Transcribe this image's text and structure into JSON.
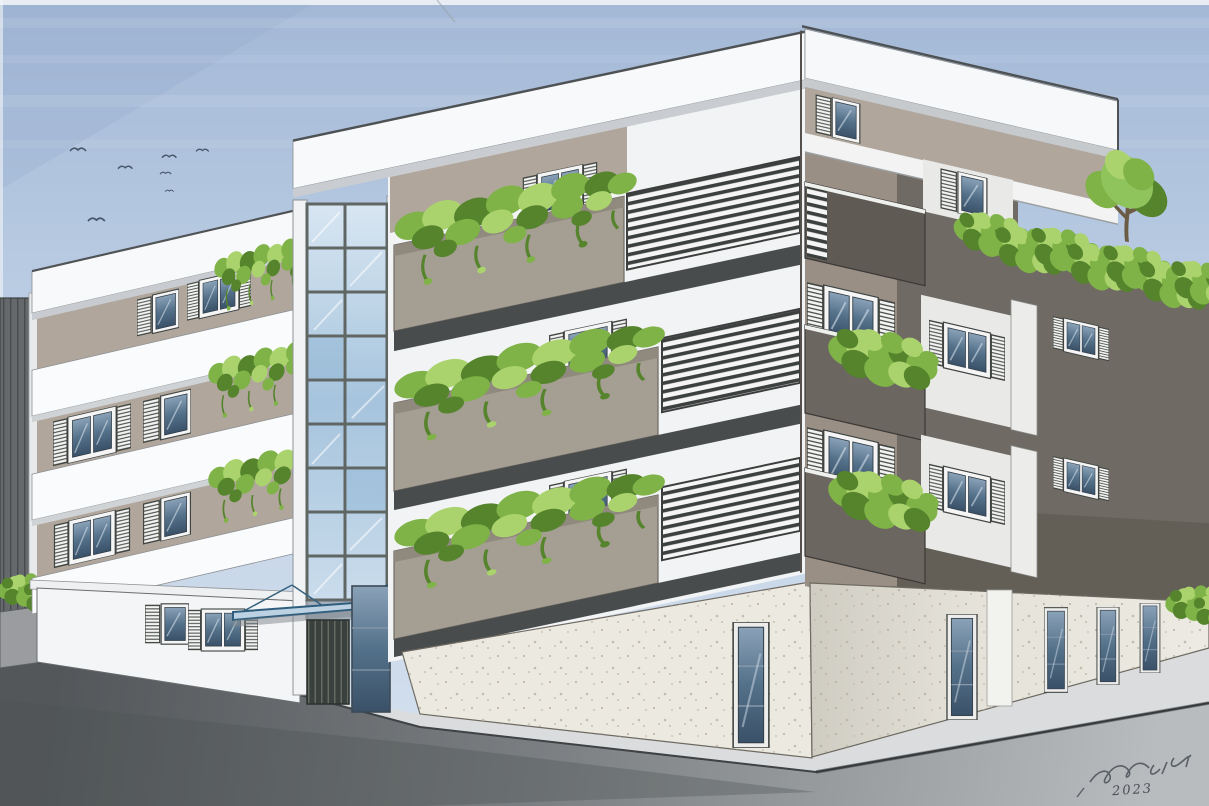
{
  "scene": {
    "medium": "hand-colored architectural perspective sketch",
    "subject": "modern four-storey corner apartment building with planted balconies, glazed stair tower, entrance canopy and roof garden",
    "signature_year": "2023",
    "birds_count": 7,
    "building": {
      "floors": 4,
      "stair_tower_glass_rows": 9,
      "stair_tower_glass_cols": 2,
      "roof_tree_count": 1,
      "balcony_style": "gray concrete parapets with cascading plants and white louvered railings"
    },
    "palette": {
      "sky_top": "#a3b8d6",
      "sky_bottom": "#d6e1ee",
      "paper_white": "#f8f9fa",
      "wall_taupe": "#b0a69c",
      "wall_taupe_corner": "#998f85",
      "wall_dark": "#6f6a63",
      "parapet_gray": "#a49e93",
      "soffit_dark": "#494c4d",
      "plant_green": "#7fb347",
      "plant_green_dark": "#55842c",
      "plant_green_light": "#aad36e",
      "glass_blue": "#9fc0da",
      "road_dark": "#5c6063",
      "sidewalk_gray": "#dadcdd",
      "travertine": "#ece9e1",
      "canopy_blue": "#2f5d7d"
    }
  }
}
